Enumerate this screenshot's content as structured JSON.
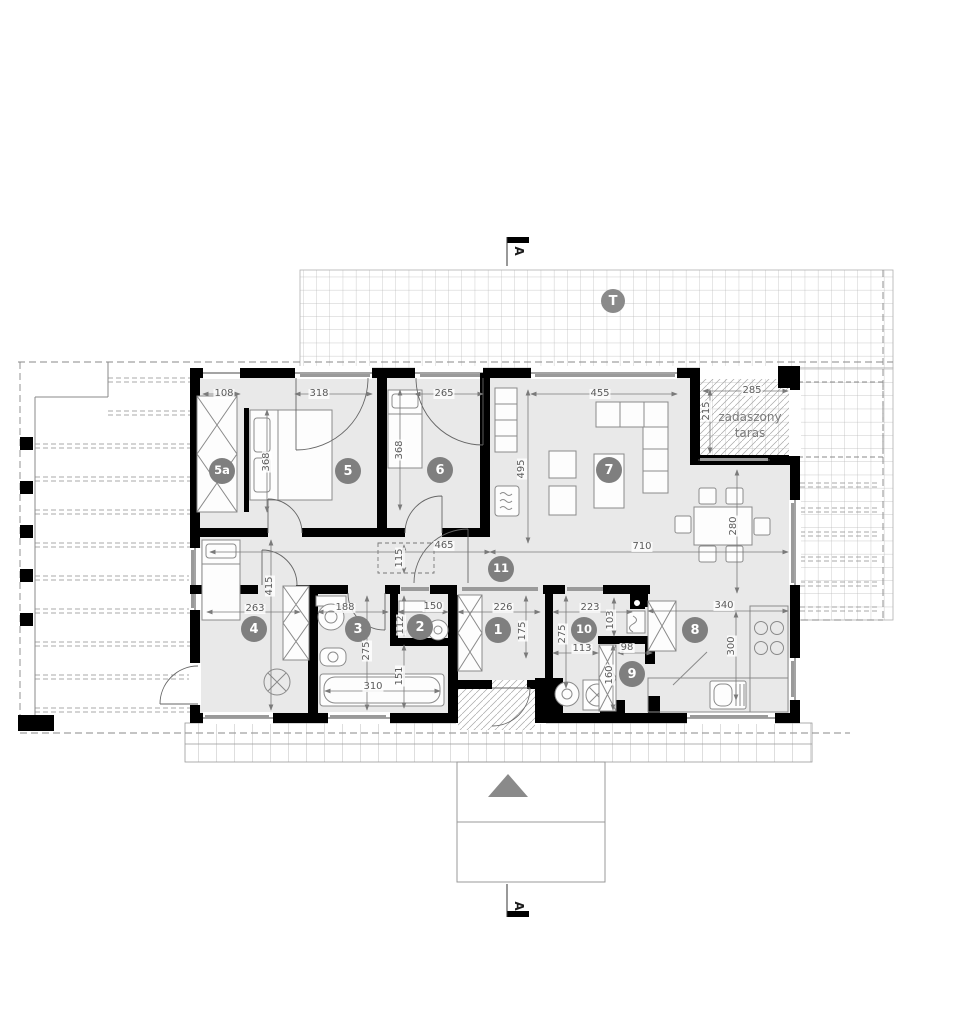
{
  "markers": {
    "section_top": "A",
    "section_bottom": "A",
    "terrace_badge": "T"
  },
  "labels": {
    "covered_terrace_line1": "zadaszony",
    "covered_terrace_line2": "taras"
  },
  "room_numbers": {
    "r5a": "5a",
    "r5": "5",
    "r6": "6",
    "r7": "7",
    "r4": "4",
    "r3": "3",
    "r2": "2",
    "r1": "1",
    "r11": "11",
    "r10": "10",
    "r9": "9",
    "r8": "8"
  },
  "dimensions_cm": {
    "closet_window_width": "108",
    "bedroom5_terrace_door": "318",
    "bedroom6_window": "265",
    "living_room_window": "455",
    "covered_terrace_width": "285",
    "covered_terrace_depth": "215",
    "bedroom5_length": "368",
    "bedroom6_length": "368",
    "living_room_depth": "495",
    "corridor_width": "465",
    "corridor_recess": "115",
    "living_zone_width": "710",
    "dining_area_depth": "280",
    "bedroom4_width": "263",
    "bedroom4_depth": "415",
    "bathroom_width": "188",
    "bathroom_depth": "275",
    "bathtub_length": "310",
    "bathtub_nook_depth": "151",
    "wc_width": "150",
    "wc_depth": "112",
    "hall_width": "226",
    "hall_depth": "175",
    "utility_width": "223",
    "utility_depth": "275",
    "utility_lower_width": "113",
    "utility_right_depth": "103",
    "pantry_width": "98",
    "pantry_depth": "160",
    "kitchen_width": "340",
    "kitchen_depth": "300"
  },
  "colors": {
    "wall": "#000000",
    "floor": "#e9e9e9",
    "badge": "#7f7f7f",
    "dim_text": "#5b5b5b",
    "grid_line": "#b9b9b9",
    "hatch": "#a8a8a8",
    "arrow_triangle": "#8a8a8a"
  }
}
